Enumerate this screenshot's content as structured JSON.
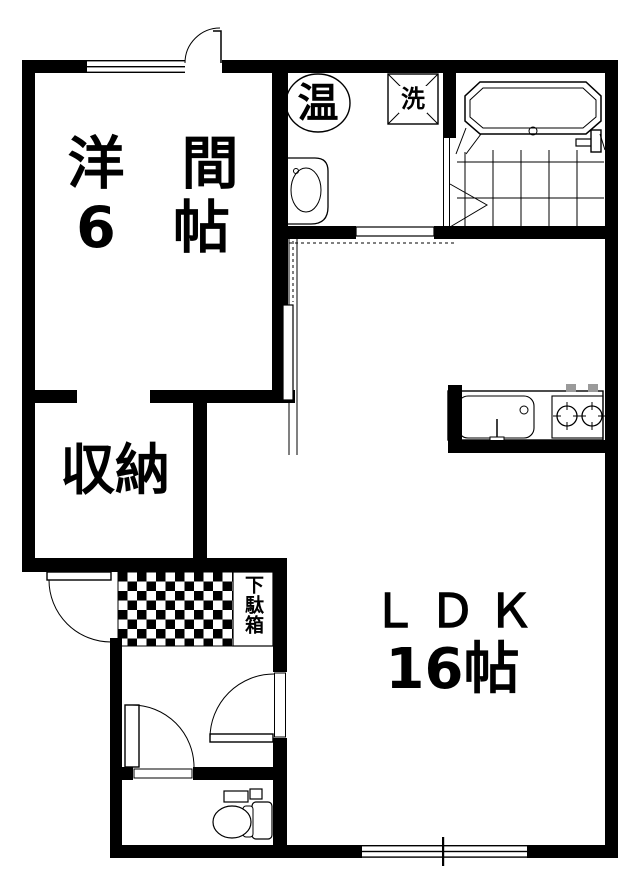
{
  "floorplan": {
    "bg_color": "#ffffff",
    "wall_color": "#000000",
    "fixture_line_color": "#000000",
    "stove_knob_color": "#9a9a9a",
    "rooms": {
      "western_room": {
        "name_line": "洋　間",
        "size_line": "6　帖"
      },
      "storage": {
        "name": "収納"
      },
      "ldk": {
        "name": "ＬＤＫ",
        "size": "16帖"
      },
      "washroom": {
        "water_heater": "温",
        "washing_machine": "洗"
      },
      "entrance": {
        "shoe_cabinet": "下駄箱"
      }
    }
  }
}
